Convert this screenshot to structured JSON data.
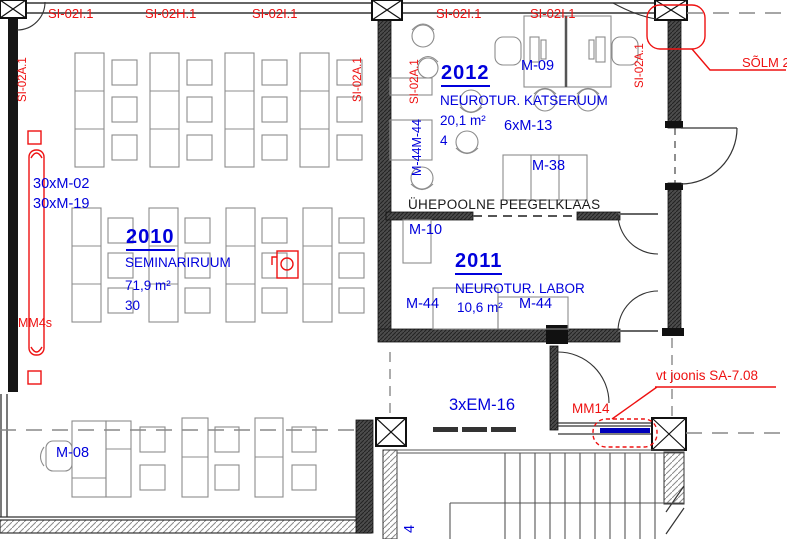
{
  "colors": {
    "annotation_blue": "#0000dc",
    "annotation_red": "#ee1111",
    "linework": "#1a1a1a"
  },
  "wall_codes": {
    "horizontal": [
      "SI-02I.1",
      "SI-02H.1",
      "SI-02I.1",
      "SI-02I.1",
      "SI-02I.1"
    ],
    "vertical": "SI-02A.1"
  },
  "rooms": {
    "r2010": {
      "number": "2010",
      "name": "SEMINARIRUUM",
      "area": "71,9 m²",
      "capacity": "30",
      "furniture_1": "30xM-02",
      "furniture_2": "30xM-19"
    },
    "r2012": {
      "number": "2012",
      "name": "NEUROTUR. KATSERUUM",
      "area": "20,1 m²",
      "capacity": "4",
      "desk_code": "M-09",
      "chair_code": "6xM-13",
      "table_code": "M-38",
      "wall_chairs": "M-44M-44"
    },
    "r2011": {
      "number": "2011",
      "name": "NEUROTUR. LABOR",
      "area": "10,6 m²",
      "table_left": "M-10",
      "chair_left": "M-44",
      "chair_right": "M-44"
    }
  },
  "annotations": {
    "mirror_glass": "ÜHEPOOLNE PEEGELKLAAS",
    "solm": "SÕLM 2",
    "mm4s": "MM4s",
    "mm14": "MM14",
    "detail_ref": "vt joonis SA-7.08",
    "em16": "3xEM-16",
    "m08": "M-08",
    "stair_mark": "4"
  }
}
